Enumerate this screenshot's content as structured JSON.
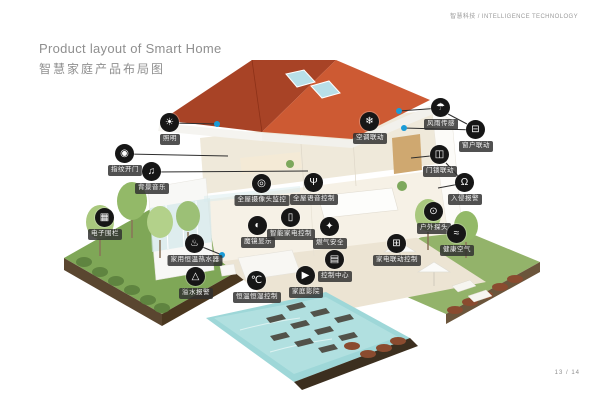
{
  "header": {
    "brand": "智慧科技 / INTELLIGENCE TECHNOLOGY"
  },
  "title": {
    "en": "Product layout of Smart Home",
    "zh": "智慧家庭产品布局图"
  },
  "footer": {
    "page": "13 / 14"
  },
  "colors": {
    "accent_dot": "#1a9bd7",
    "marker_bg": "#161616",
    "label_bg": "#303030",
    "roof_left": "#a84326",
    "roof_right": "#cd5a33",
    "pool": "#9ed7d8",
    "grass": "#7fa757"
  },
  "products": [
    {
      "label": "照明",
      "icon": "bulb-icon",
      "pos": [
        170,
        123
      ],
      "line": [
        217,
        124
      ],
      "dot": true
    },
    {
      "label": "指纹开门",
      "icon": "fingerprint-icon",
      "pos": [
        125,
        154
      ],
      "line": [
        228,
        156
      ]
    },
    {
      "label": "背景音乐",
      "icon": "music-note-icon",
      "pos": [
        152,
        172
      ],
      "line": [
        308,
        171
      ]
    },
    {
      "label": "电子围栏",
      "icon": "fence-icon",
      "pos": [
        105,
        218
      ]
    },
    {
      "label": "家用恒温热水器",
      "icon": "water-heater-icon",
      "pos": [
        195,
        244
      ],
      "line": [
        222,
        255
      ],
      "dot": true
    },
    {
      "label": "溢水报警",
      "icon": "overflow-alarm-icon",
      "pos": [
        196,
        277
      ]
    },
    {
      "label": "恒温恒湿控制",
      "icon": "thermo-hygro-icon",
      "pos": [
        257,
        281
      ]
    },
    {
      "label": "家庭影院",
      "icon": "home-theater-icon",
      "pos": [
        306,
        276
      ]
    },
    {
      "label": "控制中心",
      "icon": "control-center-icon",
      "pos": [
        335,
        260
      ]
    },
    {
      "label": "家电联动控制",
      "icon": "appliance-linkage-icon",
      "pos": [
        397,
        244
      ]
    },
    {
      "label": "全屋摄像头监控",
      "icon": "camera-monitor-icon",
      "pos": [
        262,
        184
      ]
    },
    {
      "label": "全屋语音控制",
      "icon": "voice-control-icon",
      "pos": [
        314,
        183
      ]
    },
    {
      "label": "魔镜显示",
      "icon": "magic-mirror-icon",
      "pos": [
        258,
        226
      ]
    },
    {
      "label": "智能家电控制",
      "icon": "smart-appliance-icon",
      "pos": [
        291,
        218
      ]
    },
    {
      "label": "燃气安全",
      "icon": "gas-safety-icon",
      "pos": [
        330,
        227
      ]
    },
    {
      "label": "空调联动",
      "icon": "ac-linkage-icon",
      "pos": [
        370,
        122
      ]
    },
    {
      "label": "风雨传感",
      "icon": "wind-rain-sensor-icon",
      "pos": [
        441,
        108
      ],
      "line": [
        399,
        111
      ],
      "dot": true
    },
    {
      "label": "窗户联动",
      "icon": "window-linkage-icon",
      "pos": [
        476,
        130
      ],
      "line": [
        404,
        128
      ],
      "dot": true
    },
    {
      "label": "门锁联动",
      "icon": "door-lock-icon",
      "pos": [
        440,
        155
      ],
      "line": [
        411,
        158
      ]
    },
    {
      "label": "入侵报警",
      "icon": "bell-icon",
      "pos": [
        465,
        183
      ],
      "line": [
        438,
        188
      ]
    },
    {
      "label": "户外探头",
      "icon": "outdoor-camera-icon",
      "pos": [
        434,
        212
      ]
    },
    {
      "label": "健康空气",
      "icon": "healthy-air-icon",
      "pos": [
        457,
        234
      ]
    }
  ],
  "extra_connectors": [
    {
      "from": [
        448,
        114
      ],
      "to": [
        467,
        124
      ]
    },
    {
      "from": [
        446,
        163
      ],
      "to": [
        458,
        176
      ]
    }
  ]
}
